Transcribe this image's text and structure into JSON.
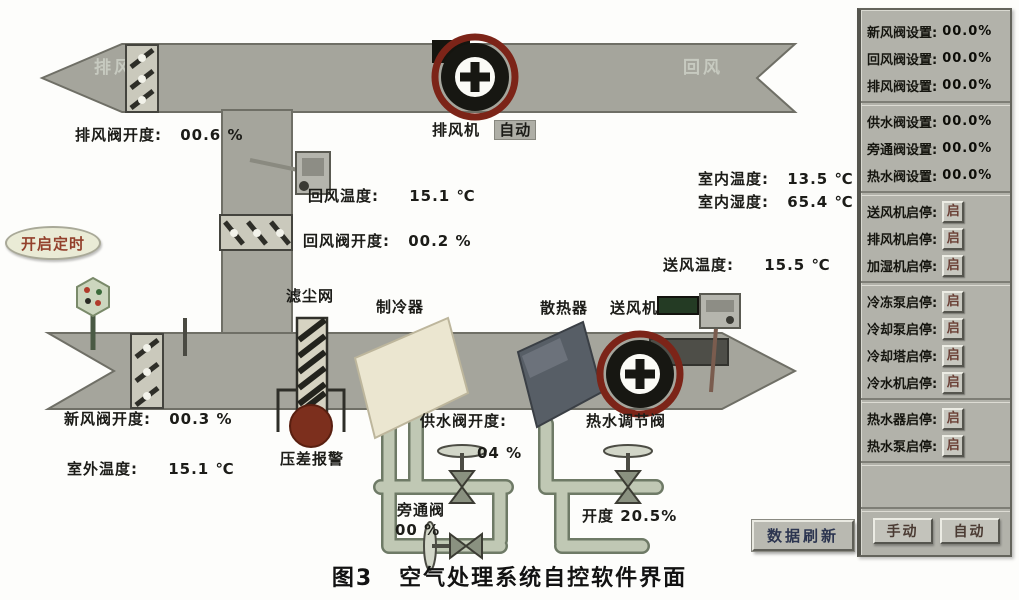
{
  "caption": {
    "fig": "图3",
    "title": "空气处理系统自控软件界面"
  },
  "colors": {
    "duct": "#a5a59c",
    "alarm_red": "#7c2f1d",
    "panel_gray": "#b2b2aa",
    "pipe_green": "#c0c8b4"
  },
  "ahu": {
    "exhaust_air_text": "排风",
    "return_air_text": "回风",
    "exhaust_fan": {
      "label": "排风机",
      "mode": "自动"
    },
    "supply_fan_label": "送风机",
    "timer_button": "开启定时",
    "filter": "滤尘网",
    "cooler": "制冷器",
    "heater": "散热器",
    "pressure_alarm": "压差报警",
    "refresh_button": "数据刷新",
    "readings": {
      "exhaust_valve": {
        "label": "排风阀开度:",
        "value": "00.6 %"
      },
      "return_temp": {
        "label": "回风温度:",
        "value": "15.1 ℃"
      },
      "return_valve": {
        "label": "回风阀开度:",
        "value": "00.2 %"
      },
      "indoor_temp": {
        "label": "室内温度:",
        "value": "13.5 ℃"
      },
      "indoor_humidity": {
        "label": "室内湿度:",
        "value": "65.4 ℃"
      },
      "supply_temp": {
        "label": "送风温度:",
        "value": "15.5 ℃"
      },
      "fresh_valve": {
        "label": "新风阀开度:",
        "value": "00.3 %"
      },
      "outdoor_temp": {
        "label": "室外温度:",
        "value": "15.1 ℃"
      },
      "supply_water_valve": {
        "label": "供水阀开度:",
        "value": "04 %"
      },
      "bypass_valve": {
        "label": "旁通阀",
        "value": "00 %"
      },
      "hot_water_valve": {
        "label": "热水调节阀",
        "value": "开度 20.5%"
      }
    }
  },
  "panel": {
    "air_valves": [
      {
        "label": "新风阀设置:",
        "value": "00.0%"
      },
      {
        "label": "回风阀设置:",
        "value": "00.0%"
      },
      {
        "label": "排风阀设置:",
        "value": "00.0%"
      }
    ],
    "water_valves": [
      {
        "label": "供水阀设置:",
        "value": "00.0%"
      },
      {
        "label": "旁通阀设置:",
        "value": "00.0%"
      },
      {
        "label": "热水阀设置:",
        "value": "00.0%"
      }
    ],
    "fan_controls": [
      {
        "label": "送风机启停:",
        "button": "启"
      },
      {
        "label": "排风机启停:",
        "button": "启"
      },
      {
        "label": "加湿机启停:",
        "button": "启"
      }
    ],
    "chiller_controls": [
      {
        "label": "冷冻泵启停:",
        "button": "启"
      },
      {
        "label": "冷却泵启停:",
        "button": "启"
      },
      {
        "label": "冷却塔启停:",
        "button": "启"
      },
      {
        "label": "冷水机启停:",
        "button": "启"
      }
    ],
    "hotwater_controls": [
      {
        "label": "热水器启停:",
        "button": "启"
      },
      {
        "label": "热水泵启停:",
        "button": "启"
      }
    ],
    "manual_button": "手动",
    "auto_button": "自动"
  }
}
